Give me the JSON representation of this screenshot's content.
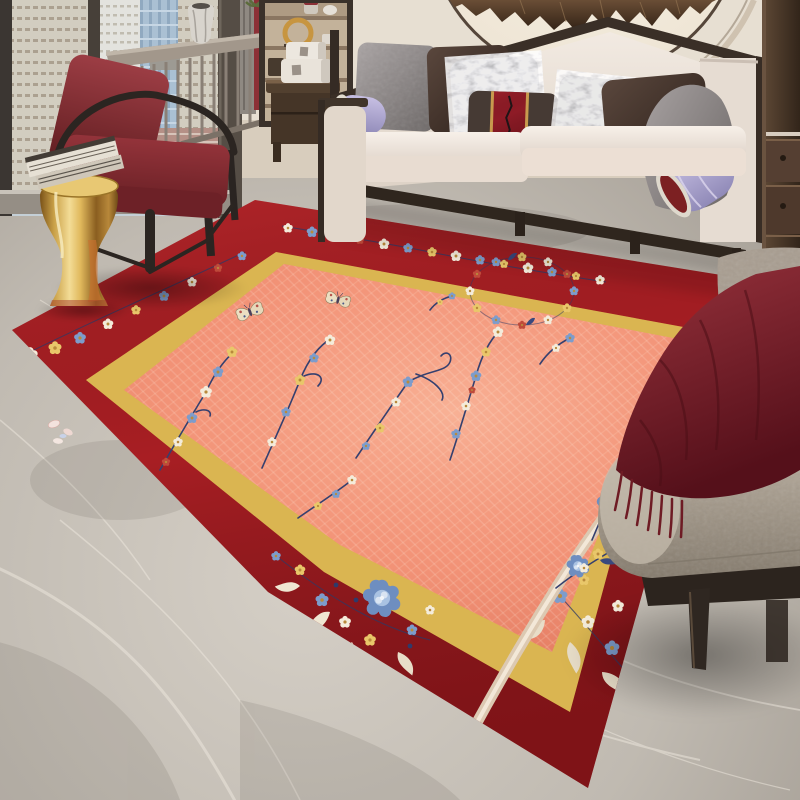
{
  "scene": {
    "title": "Modern living room with red Chinese floral area rug",
    "room_type": "living room",
    "objects": [
      {
        "name": "area-rug",
        "style": "chinoiserie floral",
        "border_color_key": "rug_red",
        "field_color_key": "rug_field",
        "inner_band_color_key": "rug_gold",
        "motifs": [
          "plum-blossom branches",
          "blue peonies",
          "butterflies",
          "floral medallion",
          "border garlands"
        ]
      },
      {
        "name": "sofa",
        "upholstery_color_key": "sofa_cream",
        "frame_color_key": "wood_dark",
        "pillow_count": 8
      },
      {
        "name": "armchair",
        "cushion_color_key": "burgundy",
        "frame_color_key": "wood_dark"
      },
      {
        "name": "accent-chair",
        "upholstery_color_key": "chair_gray",
        "throw_color_key": "throw_burgundy"
      },
      {
        "name": "gold-drum-stool",
        "color_key": "gold_stool",
        "items_on_top": "stack of books"
      },
      {
        "name": "console-table",
        "material": "gray wood"
      },
      {
        "name": "shelf-unit",
        "items": [
          "jars",
          "gold ring sculpture",
          "bowls"
        ]
      },
      {
        "name": "side-table",
        "items_on_top": "two white boxes"
      },
      {
        "name": "moon-wall-art",
        "motif": "bronze mountain relief in circle"
      },
      {
        "name": "window-city-view",
        "view": "high-rise skyline"
      },
      {
        "name": "marble-floor",
        "color_key": "marble_light"
      },
      {
        "name": "curtain",
        "accent_color_key": "curtain_red"
      },
      {
        "name": "side-cabinet",
        "color_key": "cabinet_brown"
      },
      {
        "name": "petals-on-floor",
        "count": 4
      }
    ]
  },
  "palette": {
    "marble_light": "#cdc7be",
    "marble_dark": "#a59e95",
    "wall_cream": "#e7dfd2",
    "rug_red": "#a81e23",
    "rug_red_dark": "#7c1015",
    "rug_gold": "#ecc95d",
    "rug_field": "#ef8a6f",
    "rug_field_light": "#f7ad92",
    "floral_navy": "#35406f",
    "floral_blue": "#7d9ccb",
    "floral_lightblue": "#b9cfe8",
    "floral_white": "#f4ecdb",
    "floral_yellow": "#e9c76a",
    "floral_red": "#bf4a3a",
    "sofa_cream": "#efe7de",
    "wood_dark": "#332a23",
    "burgundy": "#8c2f36",
    "throw_burgundy": "#7e2631",
    "gold_stool": "#c9973f",
    "chair_gray": "#ab9f91",
    "cabinet_brown": "#4a392d",
    "city_cream": "#d9d0bf",
    "city_blue": "#a9c0d3",
    "curtain_red": "#8c3036"
  }
}
